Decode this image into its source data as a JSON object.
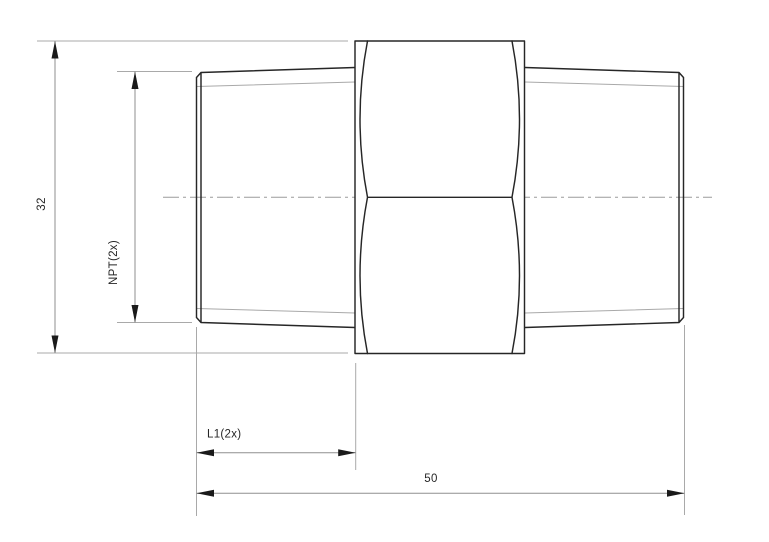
{
  "page": {
    "background": "#ffffff"
  },
  "drawing": {
    "view": "hex-pipe-nipple-side-view",
    "colors": {
      "edge": "#262626",
      "thread_line": "#a9a9a9",
      "dim_line": "#8f8f8f",
      "extension_line": "#a9a9a9",
      "centerline": "#9c9c9c",
      "arrow": "#1a1a1a",
      "label_text": "#262626"
    },
    "dimensions": {
      "outer_diameter": {
        "label": "32",
        "orientation": "vertical"
      },
      "thread_spec": {
        "label": "NPT(2x)",
        "orientation": "vertical"
      },
      "thread_length": {
        "label": "L1(2x)",
        "orientation": "horizontal"
      },
      "overall_length": {
        "label": "50",
        "orientation": "horizontal"
      }
    }
  }
}
